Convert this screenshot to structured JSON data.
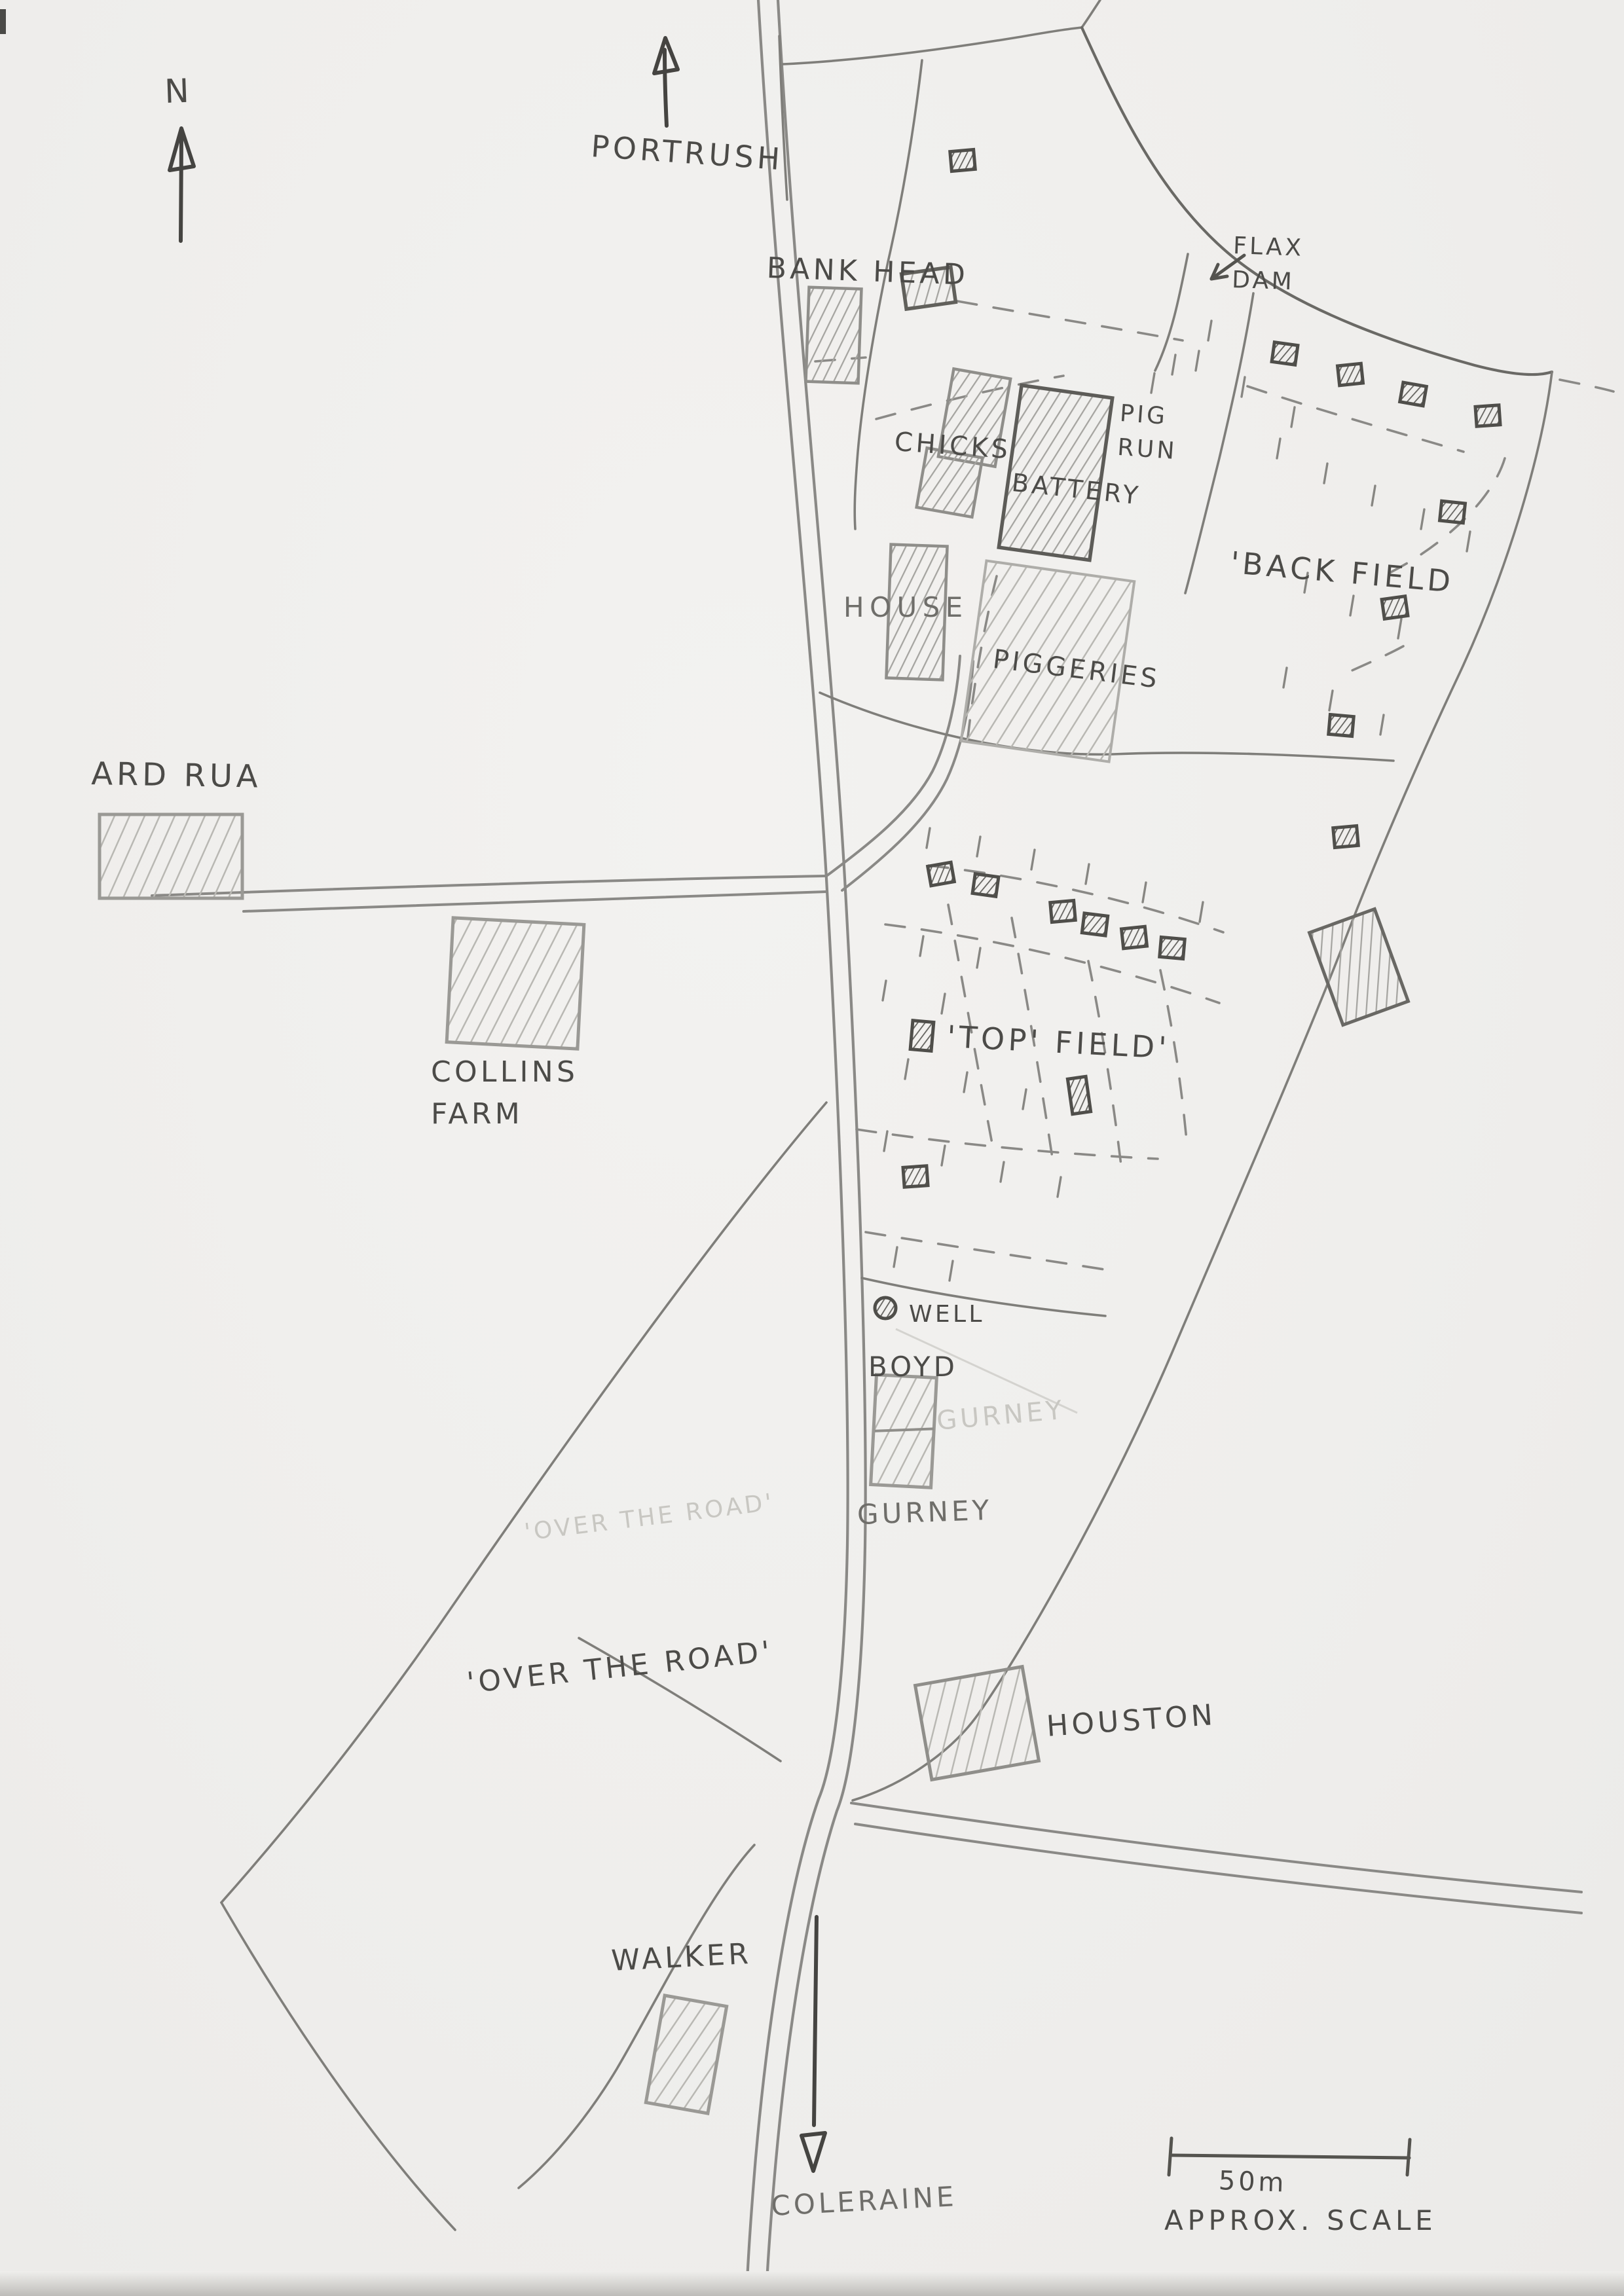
{
  "compass": {
    "north_label": "N"
  },
  "roads": {
    "north_destination": "PORTRUSH",
    "south_destination": "COLERAINE"
  },
  "farmyard": {
    "bank_head": "BANK HEAD",
    "flax_dam": "FLAX\n DAM",
    "chicks": "CHICKS",
    "battery": "BATTERY",
    "pig_run": "PIG\nRUN",
    "house": "HOUSE",
    "piggeries": "PIGGERIES",
    "well": "WELL"
  },
  "fields": {
    "back_field": "'BACK FIELD",
    "top_field": "'TOP' FIELD'",
    "over_the_road": "'OVER THE ROAD'",
    "over_the_road_ghost": "'OVER THE ROAD'"
  },
  "neighbours": {
    "ard_rua": "ARD RUA",
    "collins_farm": "COLLINS\n  FARM",
    "boyd": "BOYD",
    "gurney": "GURNEY",
    "gurney_ghost": "GURNEY",
    "houston": "HOUSTON",
    "walker": "WALKER"
  },
  "scale": {
    "distance": "50m",
    "caption": "APPROX. SCALE"
  },
  "colors": {
    "paper": "#efeeec",
    "pencil_dark": "#454441",
    "pencil": "#7f7e7a",
    "pencil_light": "#a9a8a4",
    "pencil_ghost": "#c8c7c2"
  }
}
